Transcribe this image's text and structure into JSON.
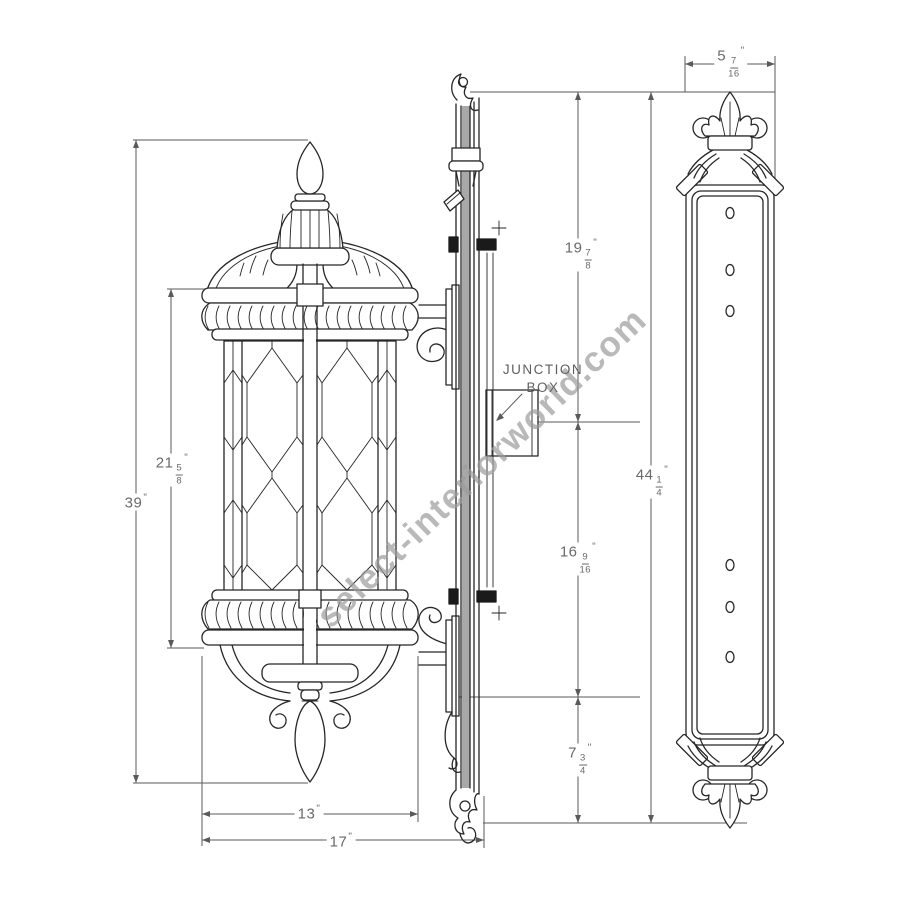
{
  "watermark": {
    "text": "select-interiorworld.com"
  },
  "junction_box": {
    "line1": "JUNCTION",
    "line2": "BOX"
  },
  "dimensions": {
    "overall_height": {
      "whole": "39",
      "unit": "\""
    },
    "body_height": {
      "whole": "21",
      "num": "5",
      "den": "8",
      "unit": "\""
    },
    "body_width": {
      "whole": "13",
      "unit": "\""
    },
    "overall_depth": {
      "whole": "17",
      "unit": "\""
    },
    "top_to_outlet": {
      "whole": "19",
      "num": "7",
      "den": "8",
      "unit": "\""
    },
    "outlet_to_arm": {
      "whole": "16",
      "num": "9",
      "den": "16",
      "unit": "\""
    },
    "arm_to_bottom": {
      "whole": "7",
      "num": "3",
      "den": "4",
      "unit": "\""
    },
    "backplate_height": {
      "whole": "44",
      "num": "1",
      "den": "4",
      "unit": "\""
    },
    "backplate_width": {
      "whole": "5",
      "num": "7",
      "den": "16",
      "unit": "\""
    }
  },
  "colors": {
    "background": "#ffffff",
    "drawing_line": "#262626",
    "dimension_line": "#5a5a5a",
    "dimension_text": "#6a6a6a",
    "watermark_text": "#9c9c9c"
  }
}
